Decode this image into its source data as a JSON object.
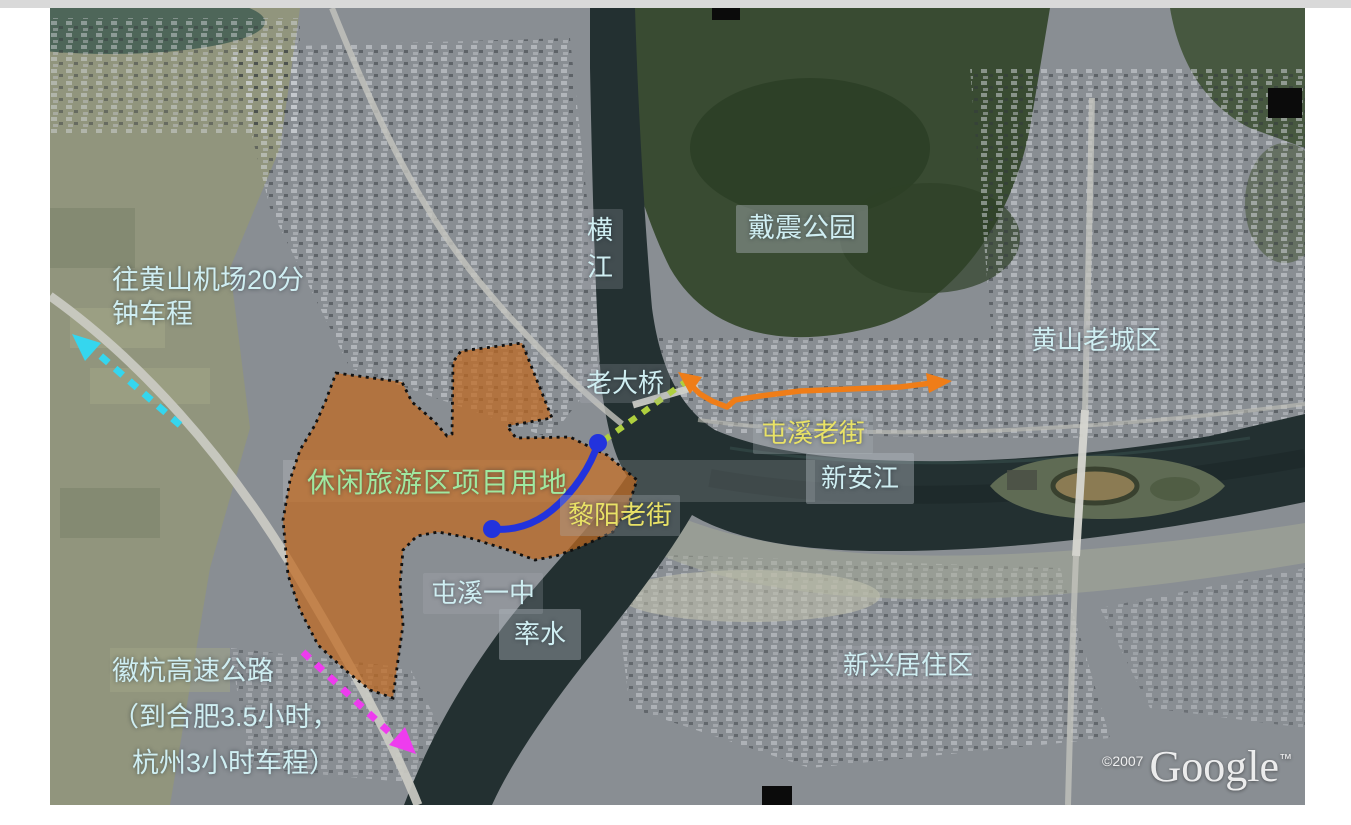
{
  "map": {
    "labels": {
      "airport_note": {
        "line1": "往黄山机场20分",
        "line2": "钟车程"
      },
      "heng_river": "横江",
      "daizhen_park": "戴震公园",
      "old_bridge": "老大桥",
      "huangshan_old_town": "黄山老城区",
      "tunxi_old_street": "屯溪老街",
      "xinan_river": "新安江",
      "project_area": "休闲旅游区项目用地",
      "liyang_old_street": "黎阳老街",
      "tunxi_no1_school": "屯溪一中",
      "shuai_river": "率水",
      "new_residential_area": "新兴居住区",
      "expressway_note": {
        "line1": "徽杭高速公路",
        "line2": "（到合肥3.5小时，",
        "line3": "杭州3小时车程）"
      }
    },
    "watermark": {
      "copyright": "©2007",
      "brand": "Google",
      "tm": "™"
    },
    "colors": {
      "label_cyan": "#cfeef2",
      "label_green": "#9fe8a0",
      "label_yellow": "#e9e266",
      "site_fill": "#c06a20",
      "site_border": "#101010",
      "route_orange": "#ef7d18",
      "route_blue": "#2233dd",
      "arrow_cyan": "#35d6ee",
      "arrow_magenta": "#ee3cee",
      "dash_green": "#aecf3e",
      "water": "#233031"
    }
  }
}
